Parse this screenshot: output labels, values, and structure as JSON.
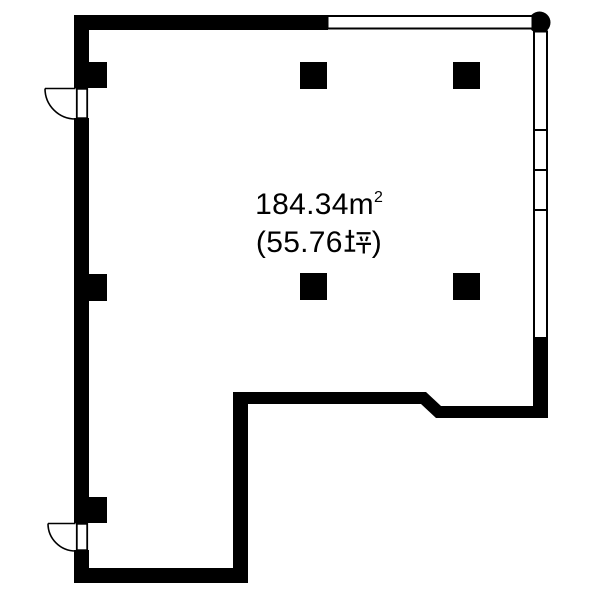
{
  "colors": {
    "wall": "#000000",
    "background": "#ffffff",
    "text": "#000000"
  },
  "area_label": {
    "square_meters_text": "184.34㎡",
    "tsubo_text": "(55.76坪)",
    "display": {
      "sqm_value": "184.34",
      "sqm_unit_base": "m",
      "sqm_unit_exponent": "2",
      "tsubo_prefix": "(55.76",
      "tsubo_kanji": "坪",
      "tsubo_suffix": ")"
    }
  },
  "plan": {
    "type": "vacant-room-floorplan",
    "windows": [
      {
        "name": "window-top",
        "side": "top",
        "dividers": 0
      },
      {
        "name": "window-right",
        "side": "right",
        "dividers": 3
      }
    ],
    "doors": [
      {
        "name": "door-upper-left",
        "side": "left",
        "swing": "outward"
      },
      {
        "name": "door-lower-left",
        "side": "left",
        "swing": "outward"
      }
    ],
    "pillars": {
      "freestanding": 4,
      "wall_mounted": 3
    },
    "corner_marker": {
      "shape": "filled-circle",
      "position": "top-right"
    }
  }
}
